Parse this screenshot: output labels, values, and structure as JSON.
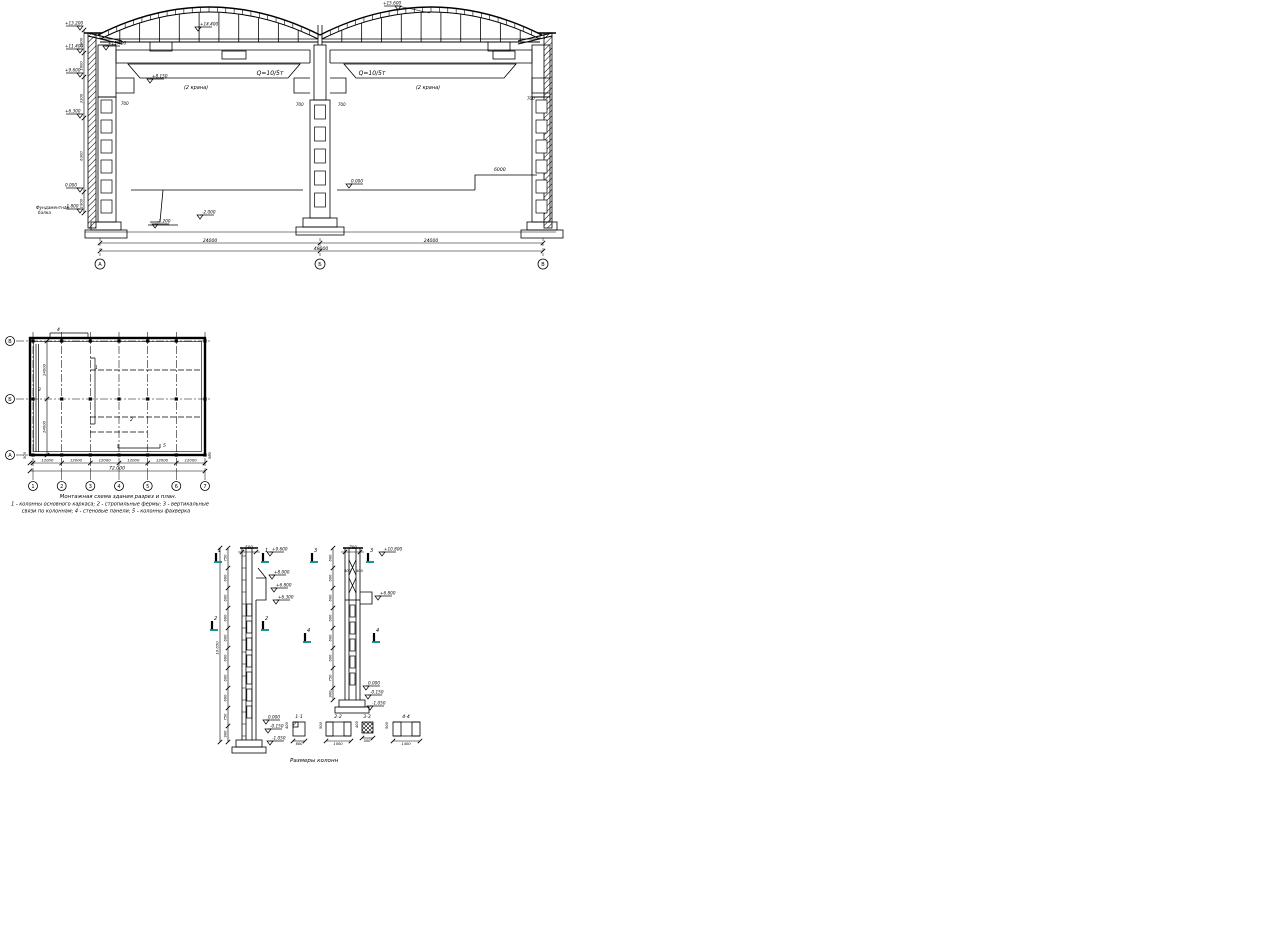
{
  "palette": {
    "ink": "#000000",
    "teal": "#008b8b",
    "paper": "#ffffff"
  },
  "section": {
    "axis_bubbles": [
      "А",
      "Б",
      "В"
    ],
    "span_dims": [
      "24000",
      "24000"
    ],
    "total_dim": "48000",
    "cranes": [
      {
        "q": "Q=10/5т",
        "count": "(2 крана)"
      },
      {
        "q": "Q=10/5т",
        "count": "(2 крана)"
      }
    ],
    "peak_mark": "+15.600",
    "ridge_mark": "+14.400",
    "eaves_marks": [
      "+11.400",
      "+8.150"
    ],
    "left_marks": [
      "+13.200",
      "+11.400",
      "+9.600",
      "+6.300",
      "0.000",
      "-1.800"
    ],
    "left_chain": [
      "1800",
      "1800",
      "3300",
      "6300",
      "1800"
    ],
    "rail_dims": [
      "700",
      "700",
      "700",
      "700"
    ],
    "floor_marks": {
      "zero": "0.000",
      "pit": "-2.000",
      "pit2": "-1.200"
    },
    "platform_dim": "6000",
    "base_note_lines": [
      "Фундаментная",
      "балка"
    ]
  },
  "plan": {
    "row_bubbles": [
      "В",
      "Б",
      "А"
    ],
    "col_bubbles": [
      "1",
      "2",
      "3",
      "4",
      "5",
      "6",
      "7"
    ],
    "bay_dims": [
      "12000",
      "12000",
      "12000",
      "12000",
      "12000",
      "12000"
    ],
    "end_dims": [
      "500",
      "500"
    ],
    "total_dim": "72.000",
    "row_dims": [
      "24000",
      "24000"
    ],
    "part_labels": [
      "1",
      "2",
      "3",
      "4",
      "5"
    ],
    "caption_lines": [
      "Монтажная схема здания разрез и план.",
      "1 - колонны основного каркаса; 2 - стропильные фермы; 3 - вертикальные",
      "связи по колоннам; 4 - стеновые панели; 5 - колонны фахверка"
    ]
  },
  "columns": {
    "caption": "Размеры колонн",
    "col1": {
      "top_dim": "500",
      "overall_dim": "10.650",
      "chain": [
        "750",
        "600",
        "600",
        "600",
        "600",
        "600",
        "600",
        "600",
        "750",
        "900"
      ],
      "marks_upper": [
        "+9.600",
        "+8.000",
        "+6.800",
        "+6.300"
      ],
      "marks_lower": [
        "0.000",
        "-0.150",
        "-1.050"
      ],
      "cuts": [
        "1",
        "2"
      ]
    },
    "col2": {
      "top_dim": "700",
      "branch_dims": [
        "400",
        "400"
      ],
      "chain": [
        "600",
        "600",
        "600",
        "600",
        "600",
        "600",
        "750",
        "900"
      ],
      "marks_upper": [
        "+10.800",
        "+6.800"
      ],
      "marks_lower": [
        "0.000",
        "-0.150",
        "-1.050"
      ],
      "cuts": [
        "3",
        "4"
      ]
    },
    "sections": [
      {
        "label": "1-1",
        "dims": [
          "400",
          "600"
        ]
      },
      {
        "label": "2-2",
        "dims": [
          "500",
          "1000"
        ]
      },
      {
        "label": "3-3",
        "dims": [
          "400",
          "500"
        ]
      },
      {
        "label": "4-4",
        "dims": [
          "500",
          "1400"
        ]
      }
    ]
  }
}
